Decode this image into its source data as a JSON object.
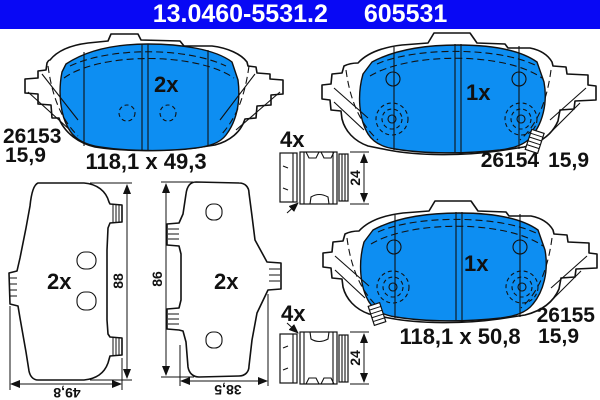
{
  "header": {
    "part_number": "13.0460-5531.2",
    "reference_number": "605531"
  },
  "colors": {
    "header_bg": "#0808F5",
    "header_text": "#FFFFFF",
    "pad_fill": "#0D8EF2",
    "line_color": "#111111",
    "background": "#FFFFFF"
  },
  "pads": {
    "pad_26153": {
      "quantity": "2x",
      "wva_number": "26153",
      "thickness_mm": "15,9",
      "dimensions": "118,1 x 49,3"
    },
    "pad_26154": {
      "quantity": "1x",
      "wva_number": "26154",
      "thickness_mm": "15,9"
    },
    "pad_26155": {
      "quantity": "1x",
      "wva_number": "26155",
      "thickness_mm": "15,9",
      "dimensions": "118,1 x 50,8"
    }
  },
  "side_views": {
    "left": {
      "quantity": "2x",
      "height_mm": "88",
      "width_mm": "49,8"
    },
    "middle": {
      "quantity": "2x",
      "height_mm": "86",
      "width_mm": "38,5"
    }
  },
  "accessories": {
    "clip_top": {
      "quantity": "4x",
      "height_mm": "24"
    },
    "clip_bottom": {
      "quantity": "4x",
      "height_mm": "24"
    }
  }
}
